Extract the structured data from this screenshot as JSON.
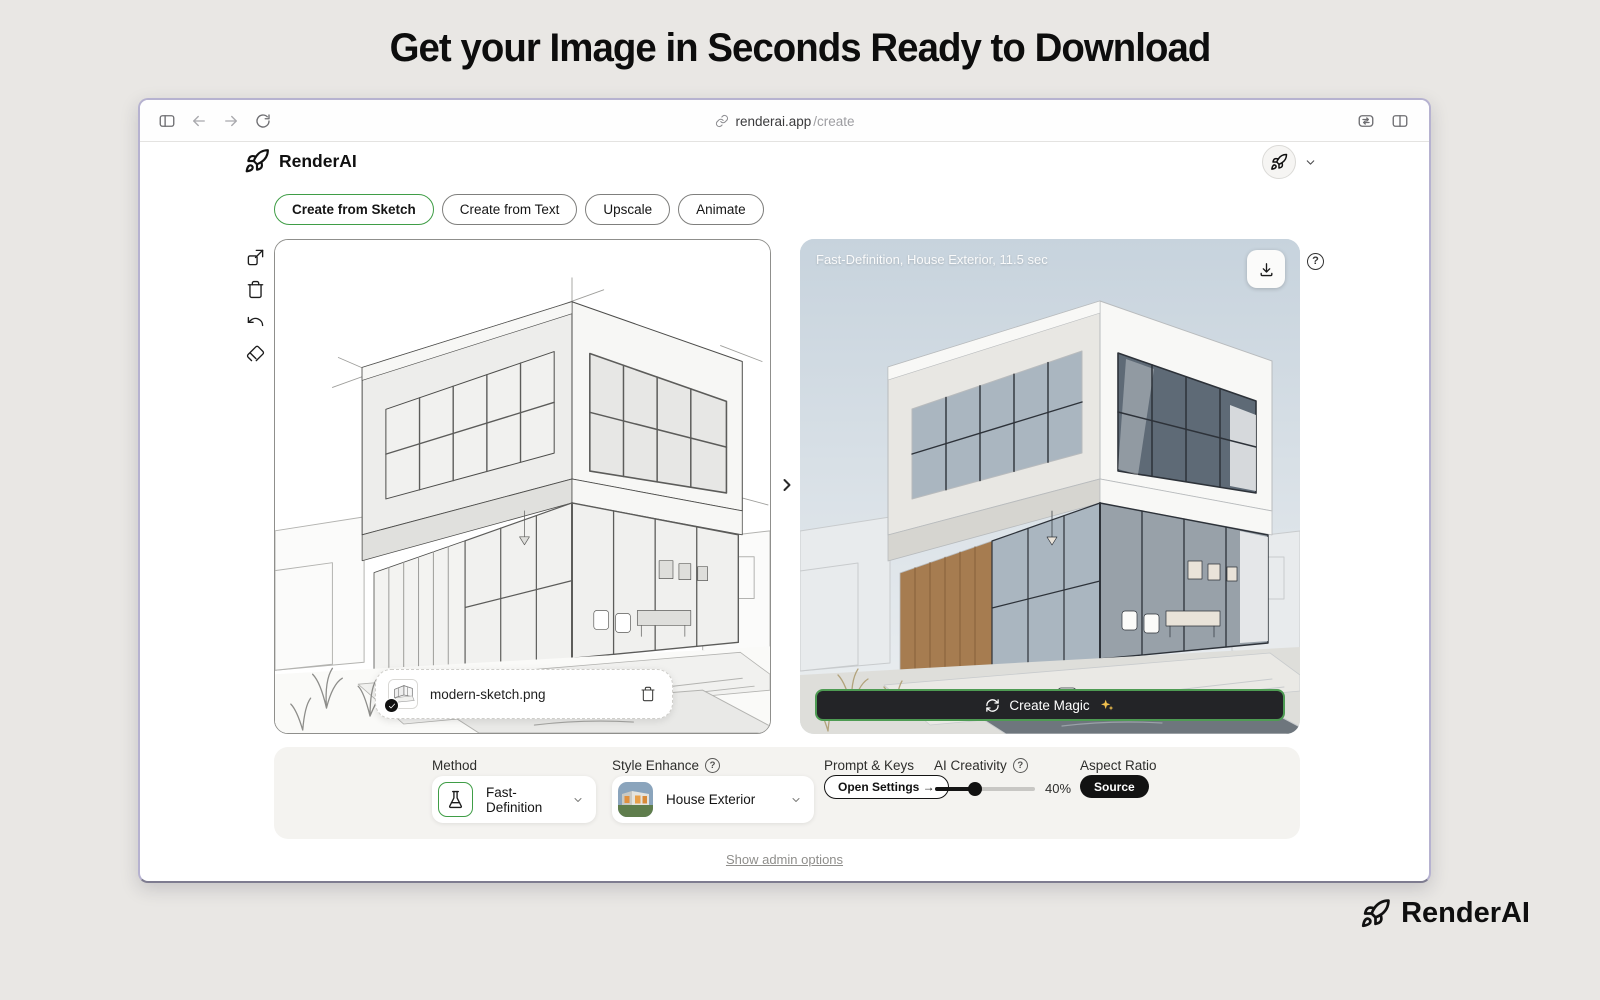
{
  "page": {
    "headline": "Get your Image in Seconds Ready to Download",
    "admin_link": "Show admin options",
    "footer_brand": "RenderAI"
  },
  "browser": {
    "url_host": "renderai.app",
    "url_path": "/create"
  },
  "header": {
    "brand": "RenderAI"
  },
  "tabs": [
    {
      "label": "Create from Sketch",
      "active": true
    },
    {
      "label": "Create from Text",
      "active": false
    },
    {
      "label": "Upscale",
      "active": false
    },
    {
      "label": "Animate",
      "active": false
    }
  ],
  "canvas": {
    "filename": "modern-sketch.png"
  },
  "result": {
    "meta": "Fast-Definition, House Exterior, 11.5 sec",
    "create_button": "Create Magic"
  },
  "controls": {
    "method_label": "Method",
    "method_value": "Fast-Definition",
    "style_label": "Style Enhance",
    "style_value": "House Exterior",
    "prompt_label": "Prompt & Keys",
    "prompt_button": "Open Settings →",
    "creativity_label": "AI Creativity",
    "creativity_pct": 40,
    "creativity_text": "40%",
    "aspect_label": "Aspect Ratio",
    "aspect_value": "Source"
  },
  "icons": {
    "help": "?"
  },
  "colors": {
    "accent_green": "#3f9d46",
    "button_dark": "#232427",
    "sparkle_yellow": "#f2c14e",
    "window_frame": "#b6b2d0"
  }
}
